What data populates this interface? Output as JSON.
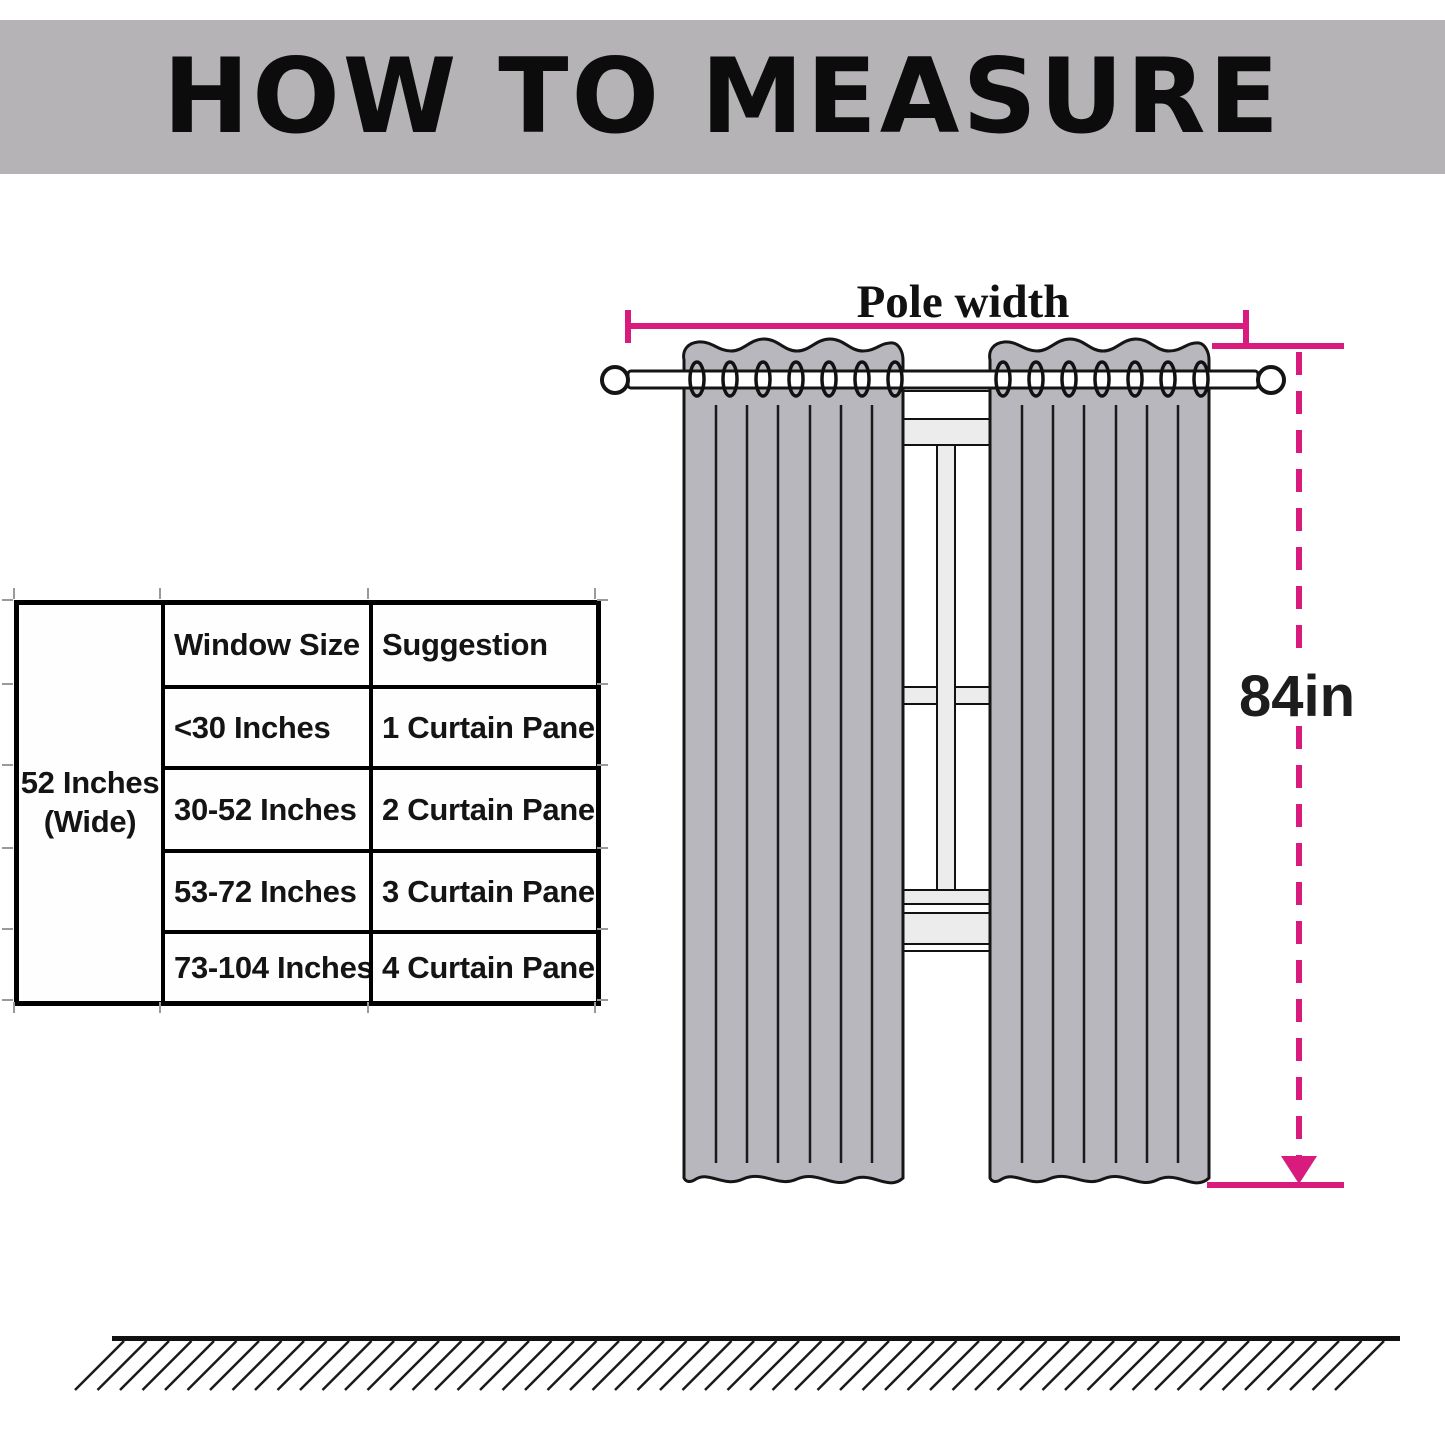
{
  "page": {
    "title": "HOW TO MEASURE"
  },
  "size_table": {
    "side_label_line1": "52 Inches",
    "side_label_line2": "(Wide)",
    "columns": [
      "Window Size",
      "Suggestion"
    ],
    "rows": [
      {
        "window_size": "<30 Inches",
        "suggestion": "1 Curtain Panel"
      },
      {
        "window_size": "30-52 Inches",
        "suggestion": "2 Curtain Panel"
      },
      {
        "window_size": "53-72 Inches",
        "suggestion": "3 Curtain Panel"
      },
      {
        "window_size": "73-104 Inches",
        "suggestion": "4 Curtain Panel"
      }
    ]
  },
  "diagram": {
    "pole_width_label": "Pole width",
    "curtain_height_label": "84in",
    "colors": {
      "measure_pink": "#d81b7c",
      "curtain_gray": "#b8b7bd",
      "banner_gray": "#b5b3b6",
      "frame_light_gray": "#ececec"
    }
  }
}
